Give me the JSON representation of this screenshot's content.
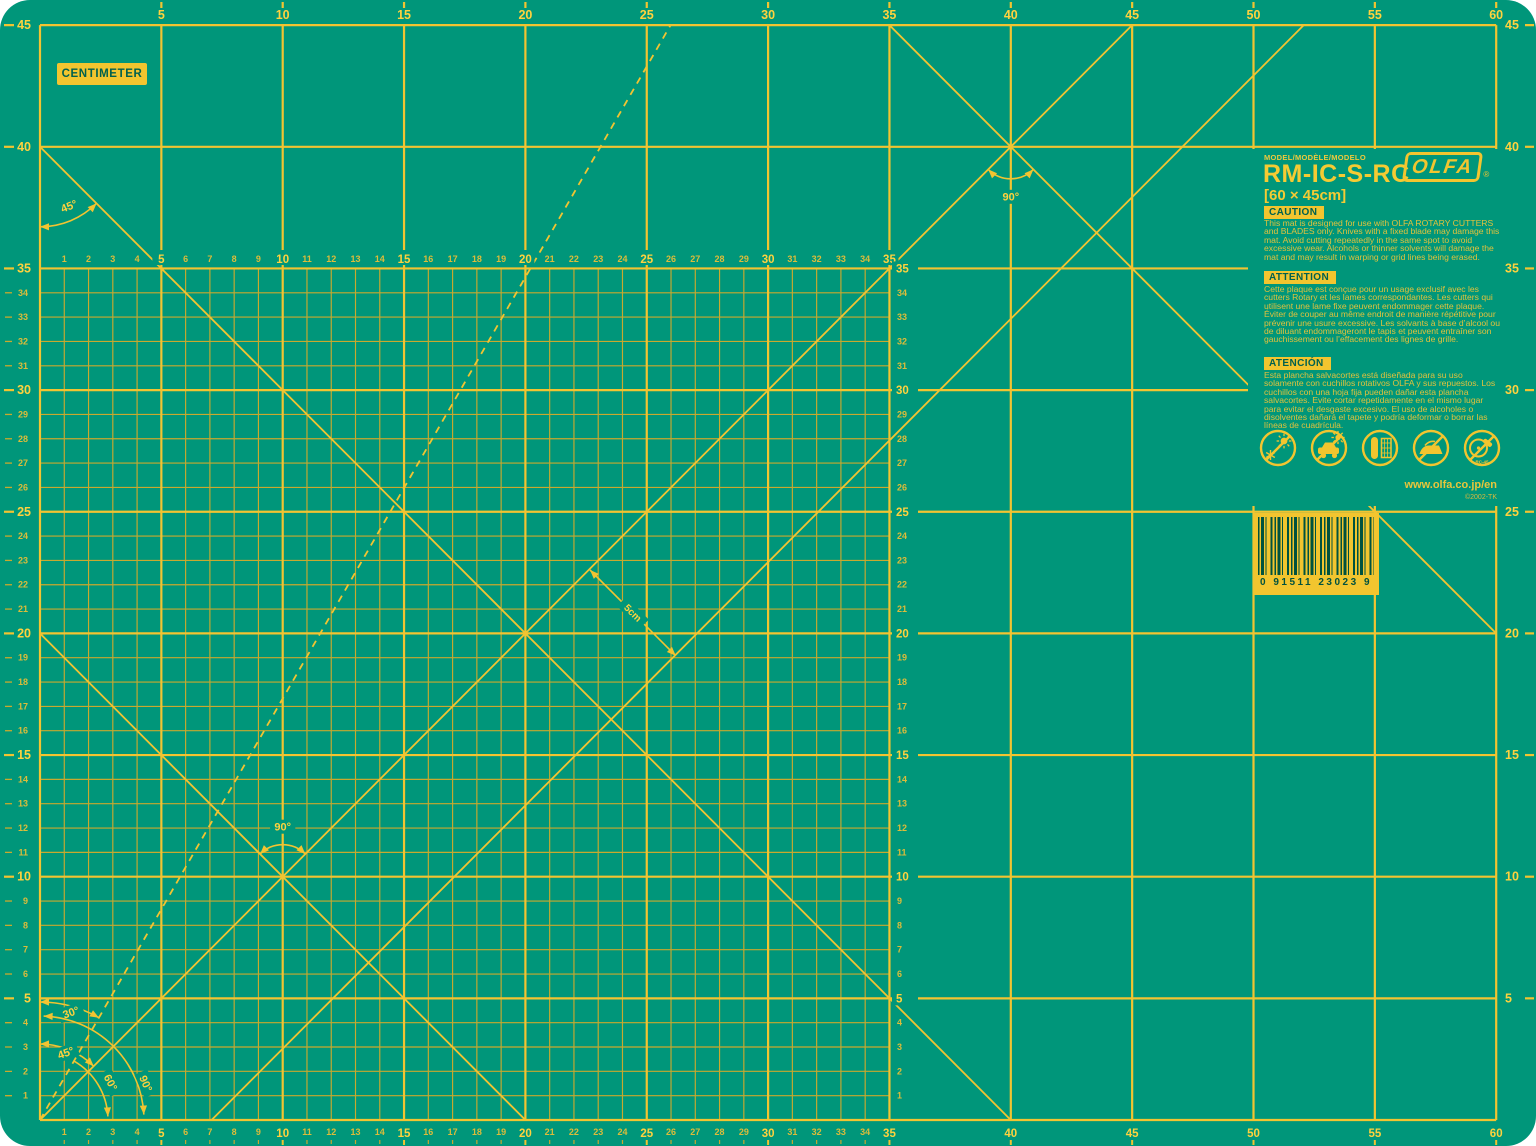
{
  "page": {
    "background": "#ffffff"
  },
  "mat": {
    "color": "#00967A",
    "unit_label": "CENTIMETER",
    "colors": {
      "line_minor": "#C9A92E",
      "line_major": "#F2C431",
      "number_small": "#DCBC3A",
      "number_bold": "#FFD23E",
      "label_box_bg": "#F2C52F",
      "label_box_text": "#00614F"
    },
    "geometry": {
      "x0": 40,
      "y0": 1120,
      "sx": 24.27,
      "sy": 24.33,
      "width_cm": 60,
      "height_cm": 45,
      "fine_cm": 35
    },
    "scales": {
      "top_bold": {
        "from": 5,
        "to": 60,
        "step": 5
      },
      "bottom_bold": {
        "from": 5,
        "to": 60,
        "step": 5
      },
      "bottom_small": {
        "from": 1,
        "to": 34
      },
      "left_bold": {
        "from": 5,
        "to": 45,
        "step": 5
      },
      "left_small": {
        "from": 1,
        "to": 34
      },
      "right_bold": {
        "from": 5,
        "to": 45,
        "step": 5
      },
      "inner_top_small": {
        "from": 1,
        "to": 34
      },
      "inner_top_bold": {
        "from": 5,
        "to": 35,
        "step": 5
      },
      "inner_right_small": {
        "from": 1,
        "to": 34
      },
      "inner_right_bold": {
        "from": 5,
        "to": 35,
        "step": 5
      }
    },
    "diagonals": [
      {
        "name": "diagonal-45-main",
        "x1": 0,
        "y1": 0,
        "x2": 45,
        "y2": 45,
        "dashed": false
      },
      {
        "name": "diagonal-45-offset",
        "x1": 7.07,
        "y1": 0,
        "x2": 52.07,
        "y2": 45,
        "dashed": false
      },
      {
        "name": "diagonal-135-short",
        "x1": 0,
        "y1": 20,
        "x2": 20,
        "y2": 0,
        "dashed": false
      },
      {
        "name": "diagonal-135-long",
        "x1": 0,
        "y1": 40,
        "x2": 40,
        "y2": 0,
        "dashed": false
      },
      {
        "name": "diagonal-135-right",
        "x1": 35,
        "y1": 45,
        "x2": 60,
        "y2": 20,
        "dashed": false
      },
      {
        "name": "diagonal-60-dashed",
        "x1": 0,
        "y1": 0,
        "x2": 25.98,
        "y2": 45,
        "dashed": true
      }
    ],
    "angle_labels": {
      "top_left_45": "45°",
      "cross_10": "90°",
      "cross_40": "90°",
      "bottom_30": "30°",
      "bottom_45": "45°",
      "bottom_60": "60°",
      "bottom_90": "90°",
      "offset_arrow": "5cm"
    }
  },
  "panel": {
    "model_label": "MODEL/MODÈLE/MODELO",
    "model": "RM-IC-S-RC",
    "size": "[60 × 45cm]",
    "brand": "OLFA",
    "brand_mark": "®",
    "caution": {
      "title": "CAUTION",
      "body": "This mat is designed for use with OLFA ROTARY CUTTERS and BLADES only. Knives with a fixed blade may damage this mat. Avoid cutting repeatedly in the same spot to avoid excessive wear. Alcohols or thinner solvents will damage the mat and may result in warping or grid lines being erased."
    },
    "attention": {
      "title": "ATTENTION",
      "body": "Cette plaque est conçue pour un usage exclusif avec les cutters Rotary et les lames correspondantes. Les cutters qui utilisent une lame fixe peuvent endommager cette plaque. Éviter de couper au même endroit de manière répétitive pour prévenir une usure excessive. Les solvants à base d’alcool ou de diluant endommageront le tapis et peuvent entraîner son gauchissement ou l’effacement des lignes de grille."
    },
    "atencion": {
      "title": "ATENCIÓN",
      "body": "Esta plancha salvacortes está diseñada para su uso solamente con cuchillos rotativos OLFA y sus repuestos. Los cuchillos con una hoja fija pueden dañar esta plancha salvacortes. Evite cortar repetidamente en el mismo lugar para evitar el desgaste excesivo. El uso de alcoholes o disolventes dañará el tapete y podría deformar o borrar las líneas de cuadrícula."
    },
    "icons": [
      "no-sun-frost-icon",
      "no-car-heat-icon",
      "store-flat-icon",
      "no-iron-icon",
      "rotary-cutter-icon"
    ],
    "cutter_label": "RC-45",
    "url": "www.olfa.co.jp/en",
    "copyright": "©2002-TK",
    "barcode_digits": "0 91511 23023 9"
  }
}
